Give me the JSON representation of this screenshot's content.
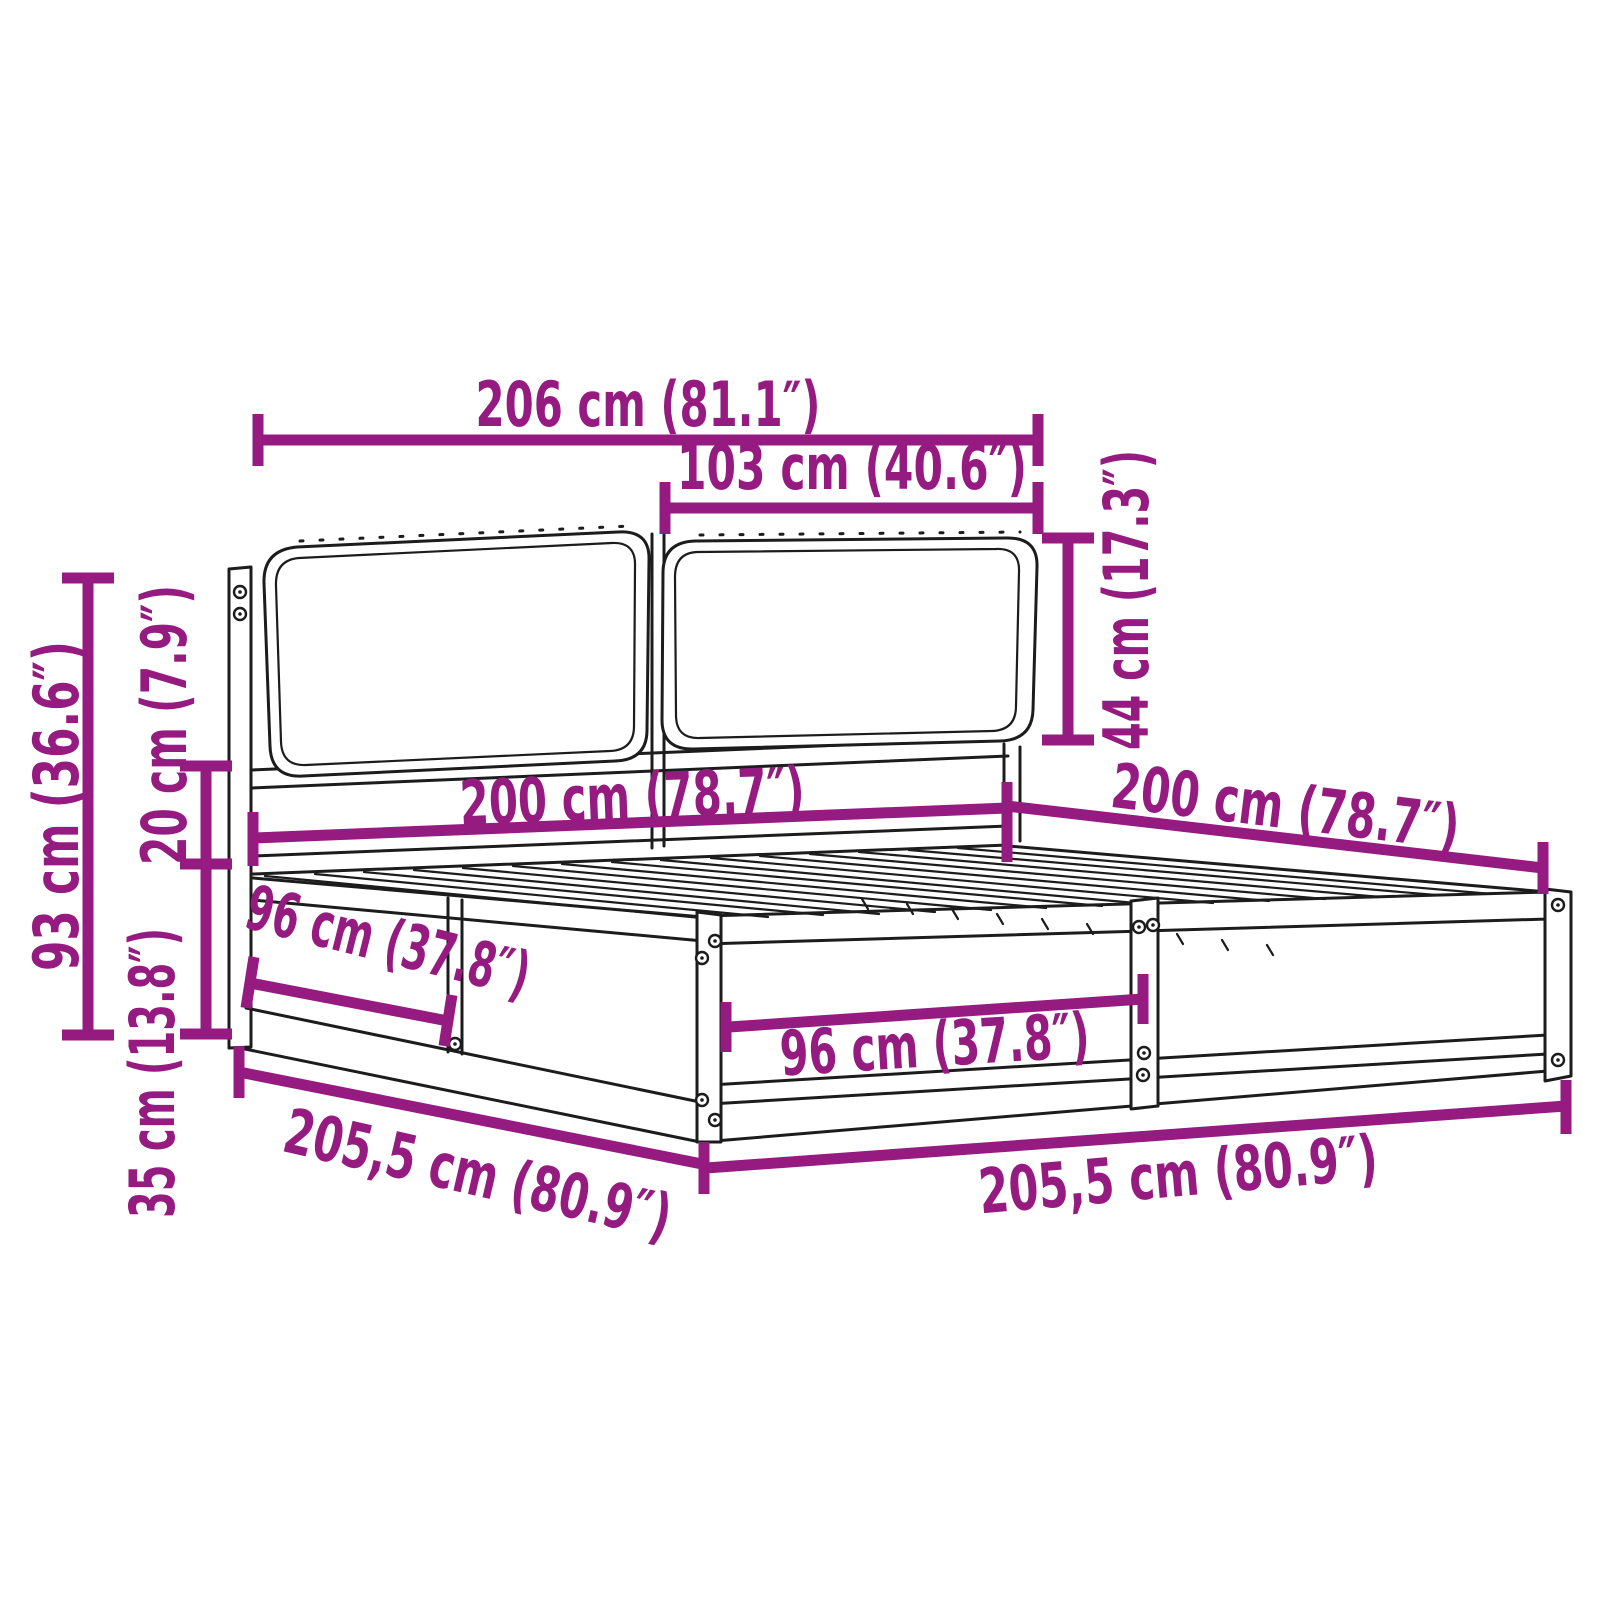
{
  "colors": {
    "accent": "#951B81",
    "ink": "#1c1c1c"
  },
  "labels": {
    "top_width": "206 cm (81.1″)",
    "cushion_width": "103 cm (40.6″)",
    "cushion_height": "44 cm (17.3″)",
    "headboard_height": "93 cm (36.6″)",
    "platform_gap": "20 cm (7.9″)",
    "base_height": "35 cm (13.8″)",
    "inner_width": "200 cm (78.7″)",
    "inner_depth": "200 cm (78.7″)",
    "side_section_length": "96 cm (37.8″)",
    "front_section_length": "96 cm (37.8″)",
    "outer_side_length": "205,5 cm (80.9″)",
    "outer_front_length": "205,5 cm (80.9″)"
  }
}
